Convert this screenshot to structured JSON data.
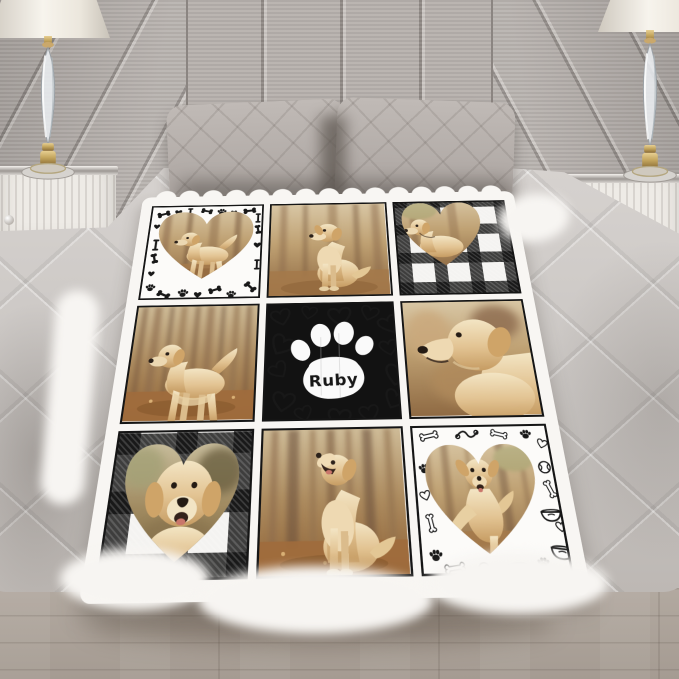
{
  "image": {
    "kind": "product-photo",
    "subject": "Personalized golden retriever photo blanket draped over a bed",
    "setting": "Bedroom with gray channel-tufted headboard, crystal table lamps on white nightstands, gray pintuck bedding and wood floor"
  },
  "blanket": {
    "name_label": "Ruby",
    "grid": {
      "rows": 3,
      "cols": 3
    },
    "cells": [
      {
        "position": "top-left",
        "shape": "heart-photo",
        "background": "white with black bones, paw prints and red hearts",
        "photo": "golden retriever standing in autumn forest"
      },
      {
        "position": "top-center",
        "shape": "full-photo",
        "background": "photo",
        "photo": "golden retriever sitting in autumn forest"
      },
      {
        "position": "top-right",
        "shape": "heart-photo",
        "background": "black and white buffalo plaid",
        "photo": "golden retriever in forest"
      },
      {
        "position": "middle-left",
        "shape": "full-photo",
        "background": "photo",
        "photo": "golden retriever standing among pine trunks"
      },
      {
        "position": "center",
        "shape": "paw-print",
        "background": "black with white heart outlines",
        "label": "Ruby"
      },
      {
        "position": "middle-right",
        "shape": "full-photo",
        "background": "photo",
        "photo": "close-up profile of golden retriever head"
      },
      {
        "position": "bottom-left",
        "shape": "heart-photo",
        "background": "black and white buffalo plaid",
        "photo": "close-up of golden retriever face"
      },
      {
        "position": "bottom-center",
        "shape": "full-photo",
        "background": "photo",
        "photo": "golden retriever sitting and looking up"
      },
      {
        "position": "bottom-right",
        "shape": "heart-photo",
        "background": "white with pet doodles: bones, paws, balls, bowls, rope toys",
        "photo": "golden retriever running in forest"
      }
    ],
    "edge": "white fleece with scalloped top edge"
  },
  "icons": {
    "bone": "bone-icon",
    "i_bone": "i-bone-icon",
    "paw": "paw-icon",
    "heart": "heart-icon",
    "heart_outline": "heart-outline-icon",
    "ball": "ball-icon",
    "bowl": "bowl-icon",
    "rope_toy": "rope-toy-icon",
    "paw_print_large": "paw-print-icon"
  },
  "colors": {
    "blanket_white": "#f8f6f3",
    "frame_black": "#151515",
    "heart_red": "#9c2026",
    "fur_tan": "#e2c392",
    "forest_brown": "#8f6a43",
    "bedding_gray": "#c9c4c1",
    "headboard_gray": "#b2acaa",
    "floor_taupe": "#aba29a",
    "lamp_gold": "#c5a75f"
  }
}
